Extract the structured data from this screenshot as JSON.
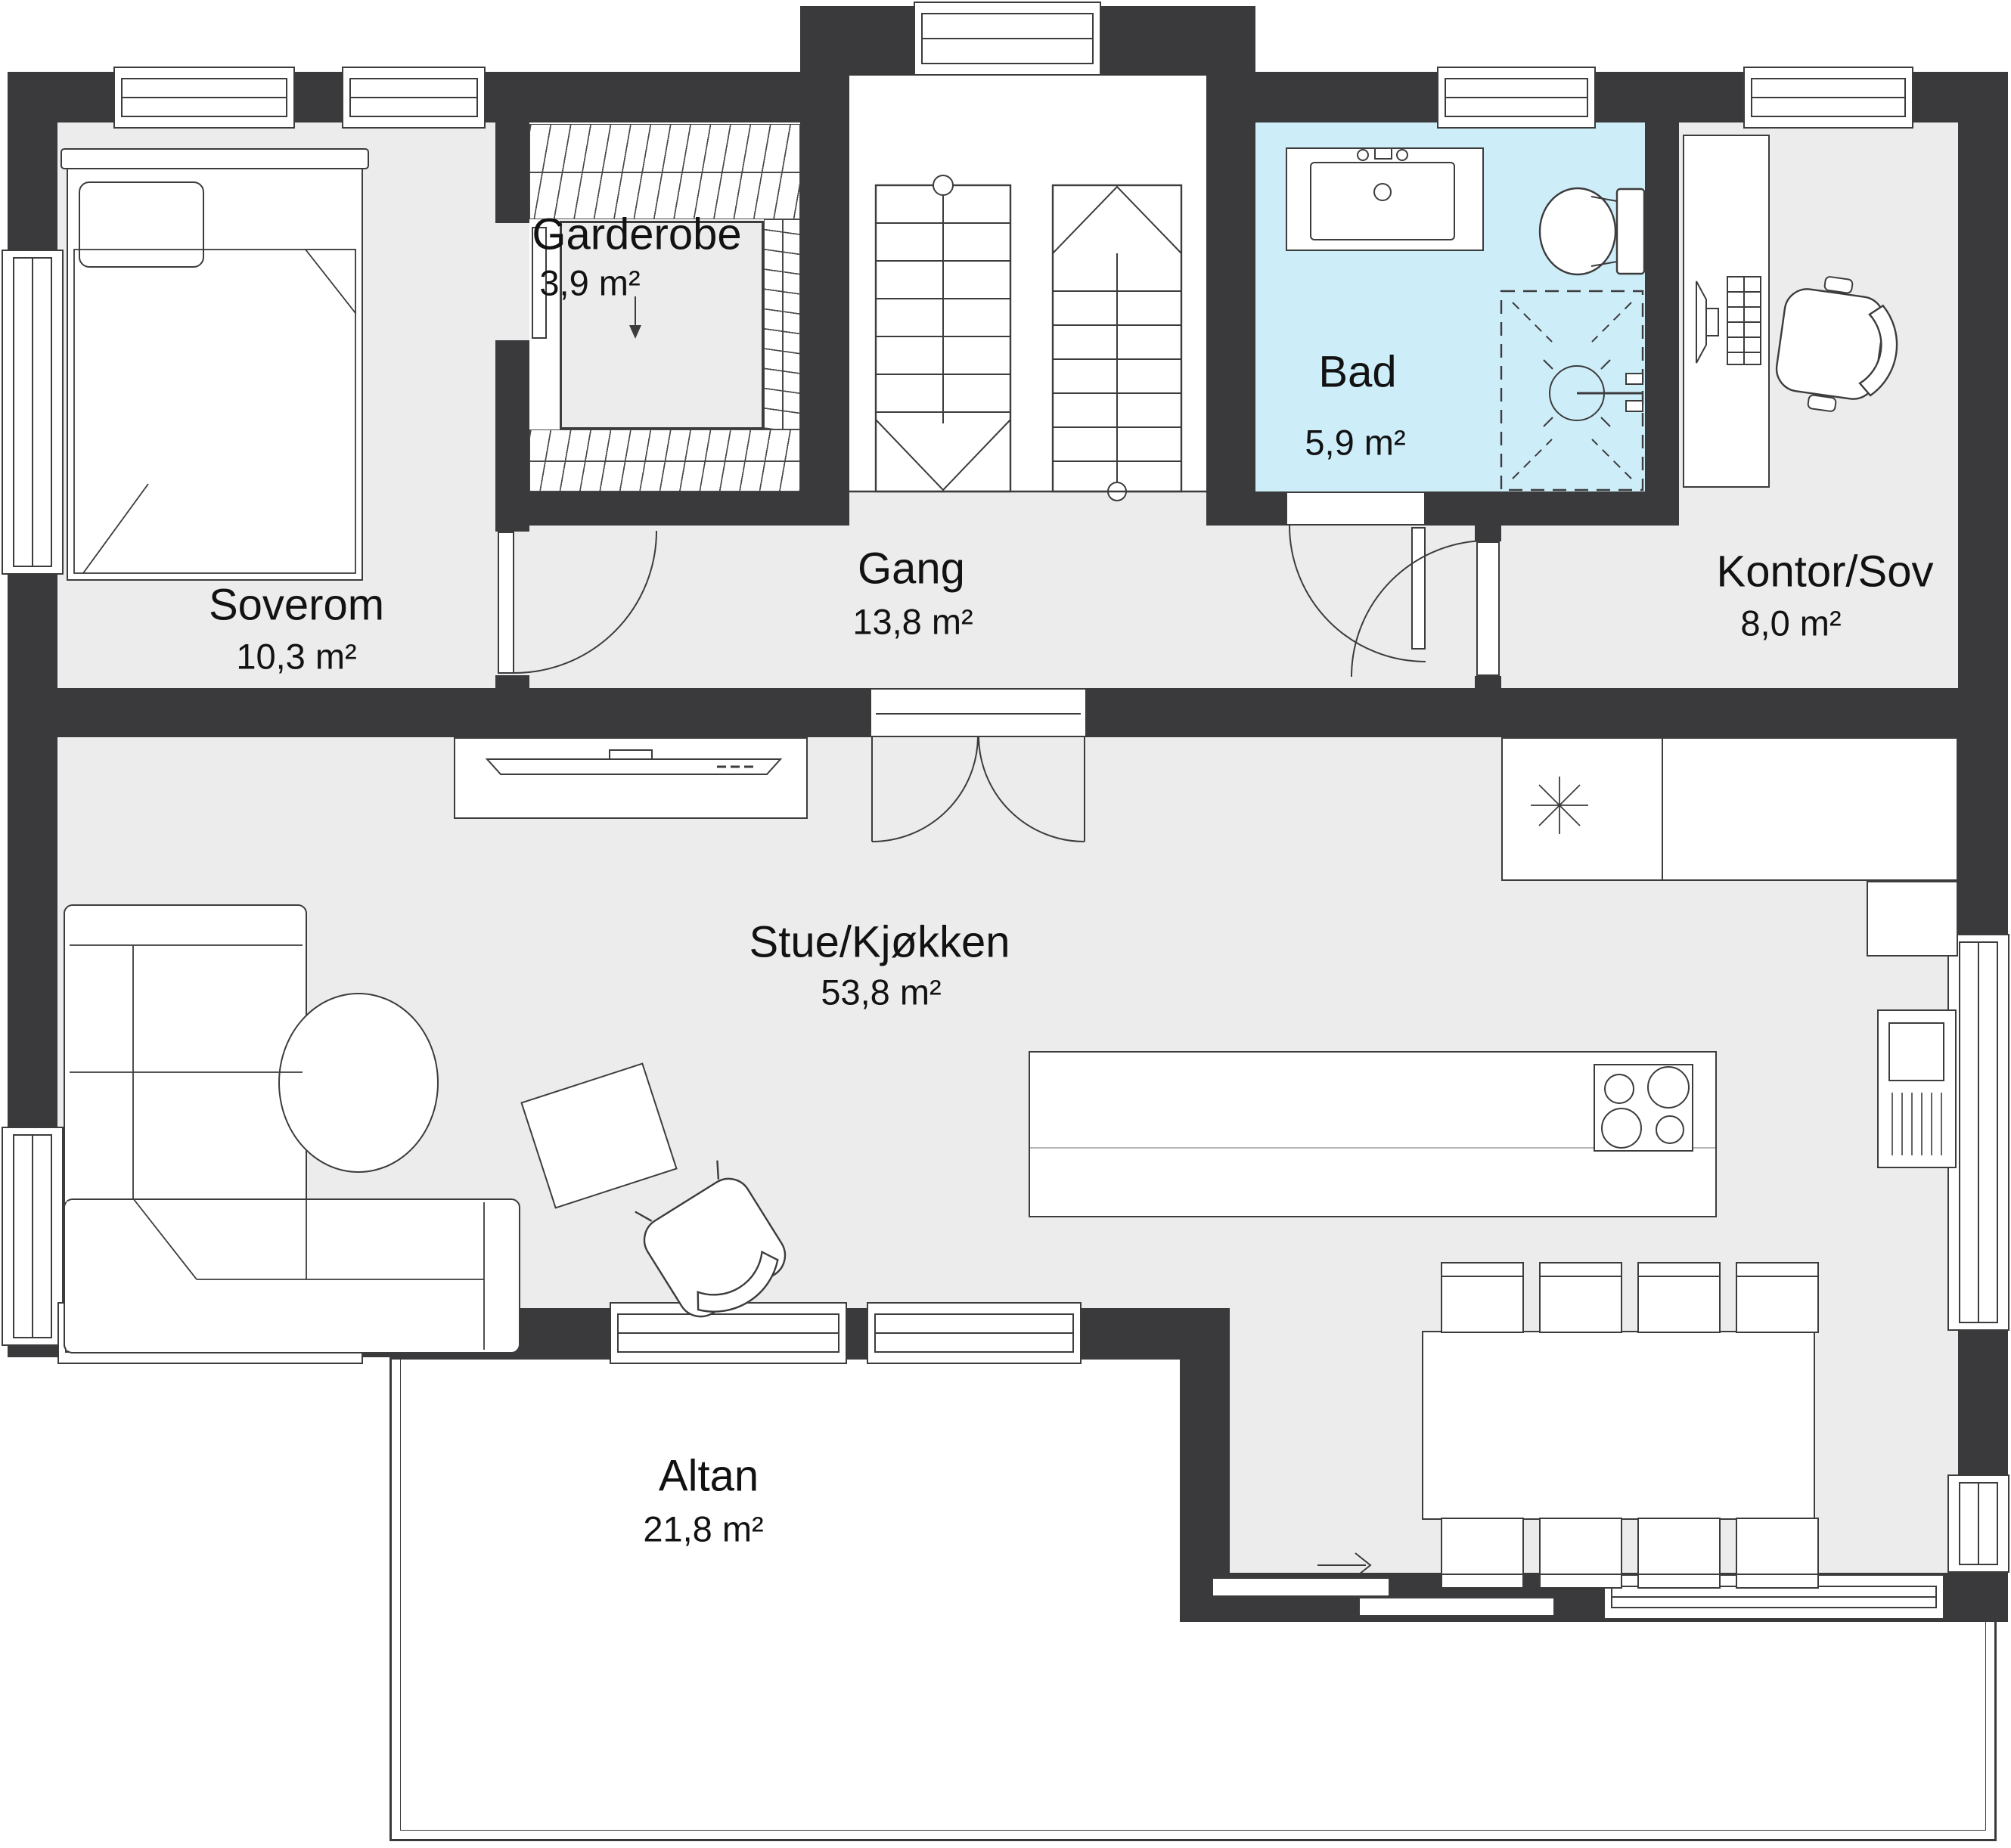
{
  "rooms": [
    {
      "id": "soverom",
      "name": "Soverom",
      "area": "10,3 m²"
    },
    {
      "id": "garderobe",
      "name": "Garderobe",
      "area": "3,9 m²"
    },
    {
      "id": "gang",
      "name": "Gang",
      "area": "13,8 m²"
    },
    {
      "id": "bad",
      "name": "Bad",
      "area": "5,9 m²"
    },
    {
      "id": "kontor",
      "name": "Kontor/Sov",
      "area": "8,0 m²"
    },
    {
      "id": "stue",
      "name": "Stue/Kjøkken",
      "area": "53,8 m²"
    },
    {
      "id": "altan",
      "name": "Altan",
      "area": "21,8 m²"
    }
  ],
  "colors": {
    "wall": "#3a3a3c",
    "floor": "#ececed",
    "bathroom_floor": "#cdedf9",
    "line": "#3c3c3c",
    "paper": "#ffffff"
  },
  "fixtures": [
    "bed",
    "wardrobe-closets",
    "staircase",
    "bathroom-sink",
    "toilet",
    "shower",
    "desk",
    "office-chair",
    "kitchen-counter",
    "kitchen-island",
    "cooktop",
    "fireplace",
    "dining-table",
    "dining-chairs",
    "corner-sofa",
    "coffee-table",
    "rug",
    "armchair",
    "tv-bench"
  ]
}
